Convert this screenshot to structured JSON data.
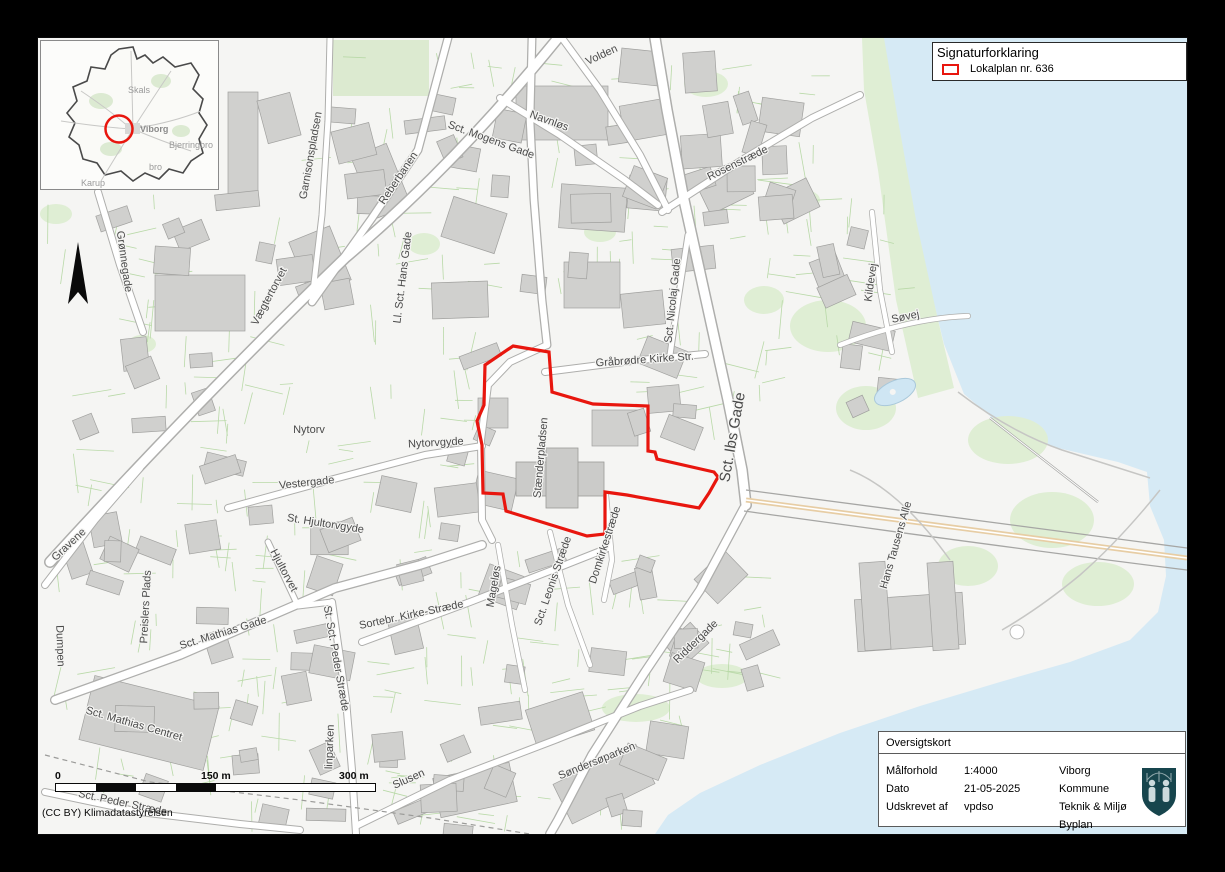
{
  "legend": {
    "title": "Signaturforklaring",
    "items": [
      {
        "label": "Lokalplan nr. 636",
        "swatch_color": "#e8160e"
      }
    ]
  },
  "info_box": {
    "title": "Oversigtskort",
    "fields": [
      {
        "label": "Målforhold",
        "value": "1:4000"
      },
      {
        "label": "Dato",
        "value": "21-05-2025"
      },
      {
        "label": "Udskrevet af",
        "value": "vpdso"
      }
    ],
    "organization": {
      "line1": "Viborg Kommune",
      "line2": "Teknik & Miljø",
      "line3": "Byplan"
    },
    "logo": "viborg-kommune-coat-of-arms"
  },
  "scale_bar": {
    "tick0": "0",
    "tick1": "150 m",
    "tick2": "300 m"
  },
  "attribution": "(CC BY) Klimadatastyrelsen",
  "inset_map": {
    "marker_color": "#e8160e",
    "labels": [
      {
        "text": "Skals",
        "x": 87,
        "y": 52,
        "bold": false
      },
      {
        "text": "Viborg",
        "x": 99,
        "y": 91,
        "bold": true
      },
      {
        "text": "Bjerringbro",
        "x": 128,
        "y": 107,
        "bold": false
      },
      {
        "text": "bro",
        "x": 108,
        "y": 129,
        "bold": false
      },
      {
        "text": "Karup",
        "x": 40,
        "y": 145,
        "bold": false
      }
    ]
  },
  "map": {
    "plan_outline": {
      "name": "Lokalplan nr. 636 boundary",
      "color": "#e8160e",
      "points": "513,346 549,352 552,392 593,404 648,406 648,451 655,452 657,459 714,472 718,477 709,493 699,508 627,495 605,492 605,534 587,536 506,511 503,494 483,493 482,445 477,421 484,405 485,365"
    },
    "street_labels": [
      {
        "t": "Volden",
        "x": 603,
        "y": 58,
        "r": -25
      },
      {
        "t": "Navnløs",
        "x": 548,
        "y": 124,
        "r": 20
      },
      {
        "t": "Sct. Mogens Gade",
        "x": 490,
        "y": 143,
        "r": 20
      },
      {
        "t": "Reberbanen",
        "x": 401,
        "y": 180,
        "r": -56
      },
      {
        "t": "Garnisonspladsen",
        "x": 314,
        "y": 156,
        "r": -80
      },
      {
        "t": "Ll. Sct. Hans Gade",
        "x": 406,
        "y": 278,
        "r": -83
      },
      {
        "t": "Grønnegade",
        "x": 121,
        "y": 262,
        "r": 82
      },
      {
        "t": "Vægtertorvet",
        "x": 272,
        "y": 298,
        "r": -62
      },
      {
        "t": "Rosenstræde",
        "x": 739,
        "y": 166,
        "r": -26
      },
      {
        "t": "Sct. Nicolaj Gade",
        "x": 676,
        "y": 301,
        "r": -84
      },
      {
        "t": "Kildevej",
        "x": 874,
        "y": 283,
        "r": -82
      },
      {
        "t": "Søvej",
        "x": 906,
        "y": 320,
        "r": -12
      },
      {
        "t": "Gråbrødre Kirke Str.",
        "x": 645,
        "y": 363,
        "r": -4
      },
      {
        "t": "Nytorv",
        "x": 309,
        "y": 433,
        "r": 0
      },
      {
        "t": "Nytorvgyde",
        "x": 436,
        "y": 446,
        "r": -3
      },
      {
        "t": "Vestergade",
        "x": 307,
        "y": 486,
        "r": -6
      },
      {
        "t": "Stænderpladsen",
        "x": 544,
        "y": 458,
        "r": -85
      },
      {
        "t": "Sct. Ibs Gade",
        "x": 737,
        "y": 438,
        "r": -80,
        "s": 15
      },
      {
        "t": "St. Hjultorvgyde",
        "x": 325,
        "y": 527,
        "r": 9
      },
      {
        "t": "Hjultorvet",
        "x": 281,
        "y": 572,
        "r": 62
      },
      {
        "t": "Gravene",
        "x": 71,
        "y": 547,
        "r": -43
      },
      {
        "t": "Preislers Plads",
        "x": 149,
        "y": 607,
        "r": -87
      },
      {
        "t": "Dumpen",
        "x": 57,
        "y": 646,
        "r": 88
      },
      {
        "t": "Sct. Mathias Gade",
        "x": 224,
        "y": 636,
        "r": -17
      },
      {
        "t": "St. Sct. Peder Stræde",
        "x": 333,
        "y": 659,
        "r": 80
      },
      {
        "t": "Sortebr. Kirke-Stræde",
        "x": 412,
        "y": 618,
        "r": -12
      },
      {
        "t": "Mageløs",
        "x": 497,
        "y": 587,
        "r": -80
      },
      {
        "t": "Sct. Leonis Stræde",
        "x": 556,
        "y": 582,
        "r": -71
      },
      {
        "t": "Domkirkestræde",
        "x": 608,
        "y": 546,
        "r": -72
      },
      {
        "t": "Sct. Mathias Centret",
        "x": 133,
        "y": 727,
        "r": 16
      },
      {
        "t": "Riddergade",
        "x": 698,
        "y": 644,
        "r": -44
      },
      {
        "t": "Hans Tausens Alle",
        "x": 899,
        "y": 546,
        "r": -74
      },
      {
        "t": "Søndersøparken",
        "x": 598,
        "y": 764,
        "r": -22
      },
      {
        "t": "Slusen",
        "x": 410,
        "y": 782,
        "r": -24
      },
      {
        "t": "Sct. Peder Stræde",
        "x": 122,
        "y": 806,
        "r": 12
      },
      {
        "t": "linparken",
        "x": 333,
        "y": 747,
        "r": -88
      }
    ]
  }
}
